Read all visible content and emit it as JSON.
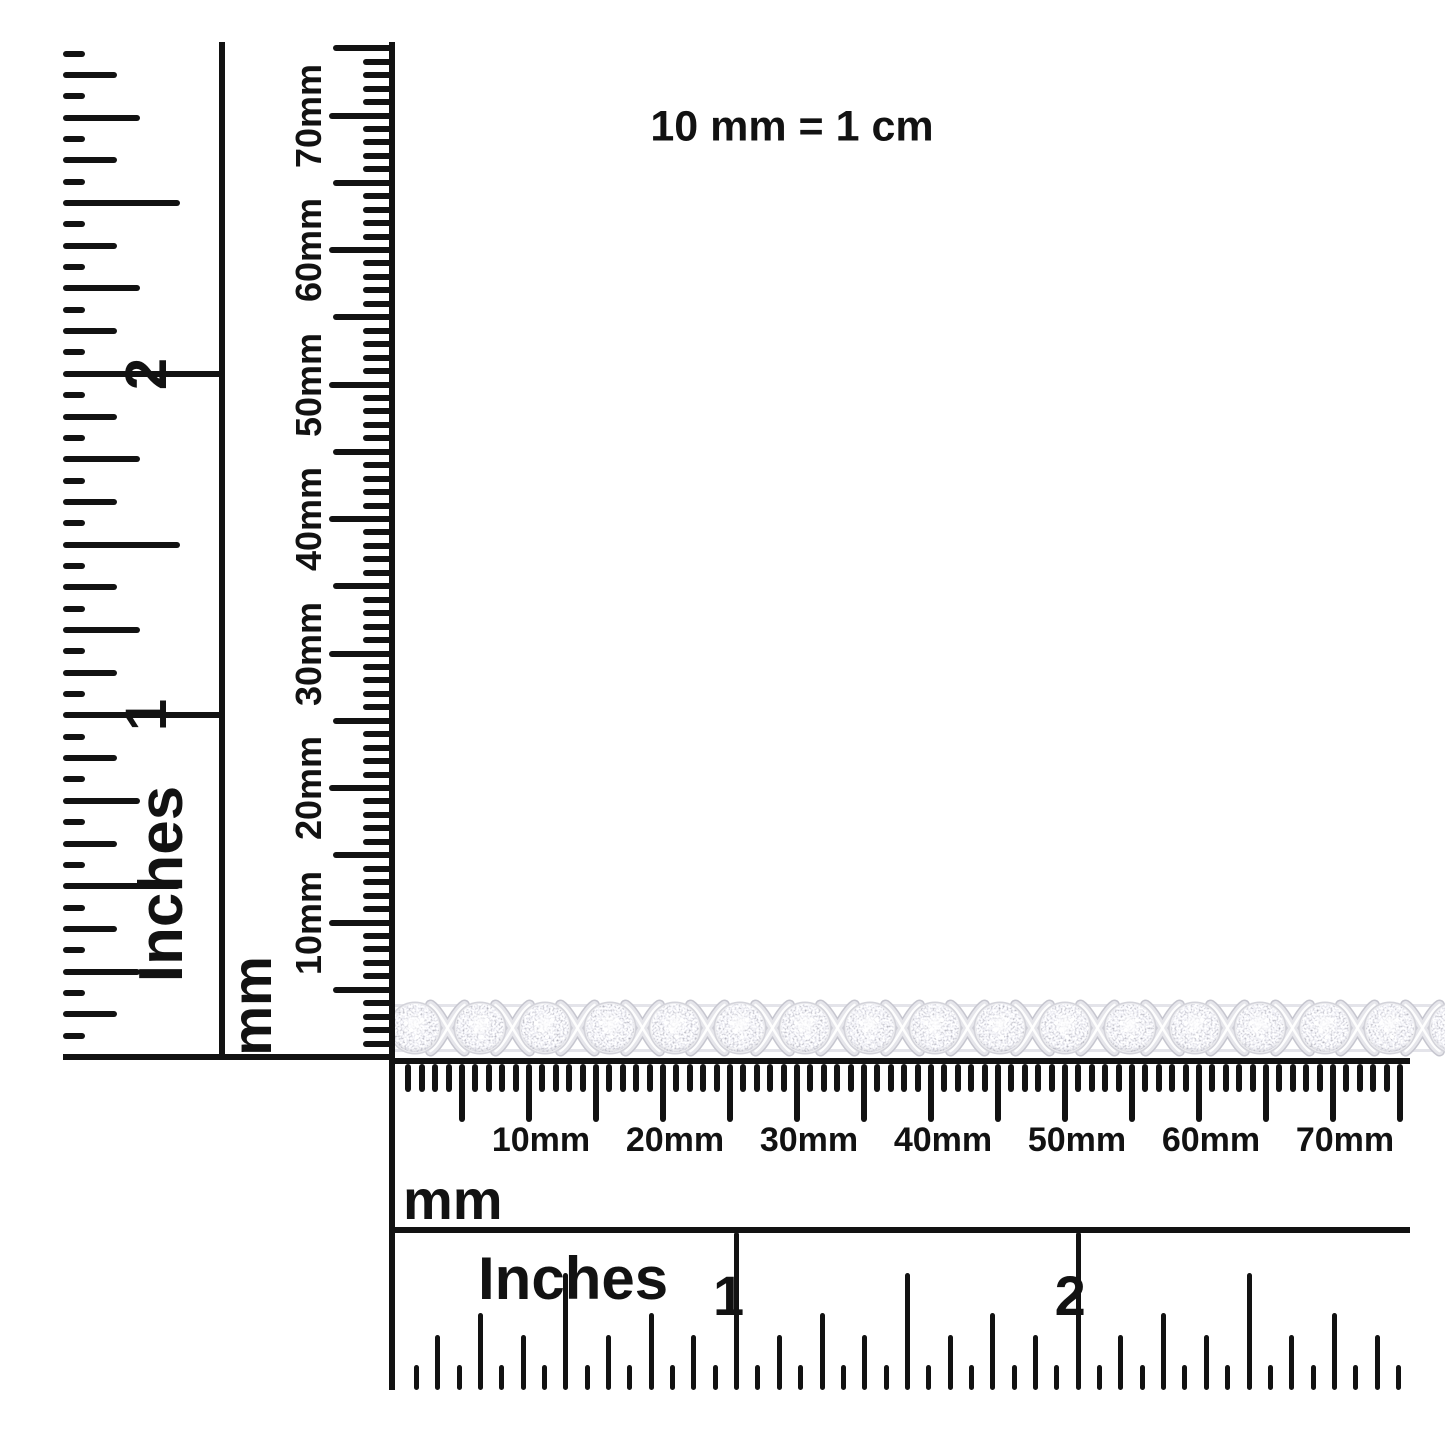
{
  "scale_note": {
    "text": "10 mm = 1 cm"
  },
  "rulers": {
    "left_inches": {
      "unit": "Inches",
      "numbers": [
        "1",
        "2"
      ]
    },
    "left_mm": {
      "unit": "mm",
      "labels": [
        "10mm",
        "20mm",
        "30mm",
        "40mm",
        "50mm",
        "60mm",
        "70mm"
      ]
    },
    "bottom_mm": {
      "unit": "mm",
      "labels": [
        "10mm",
        "20mm",
        "30mm",
        "40mm",
        "50mm",
        "60mm",
        "70mm"
      ]
    },
    "bottom_inches": {
      "unit": "Inches",
      "numbers": [
        "1",
        "2"
      ]
    }
  },
  "bracelet": {
    "cluster_count": 16
  },
  "colors": {
    "ink": "#121212",
    "background": "#ffffff",
    "metal_light": "#ededf0",
    "metal_mid": "#d3d3da",
    "metal_deep": "#c6c6cf"
  }
}
